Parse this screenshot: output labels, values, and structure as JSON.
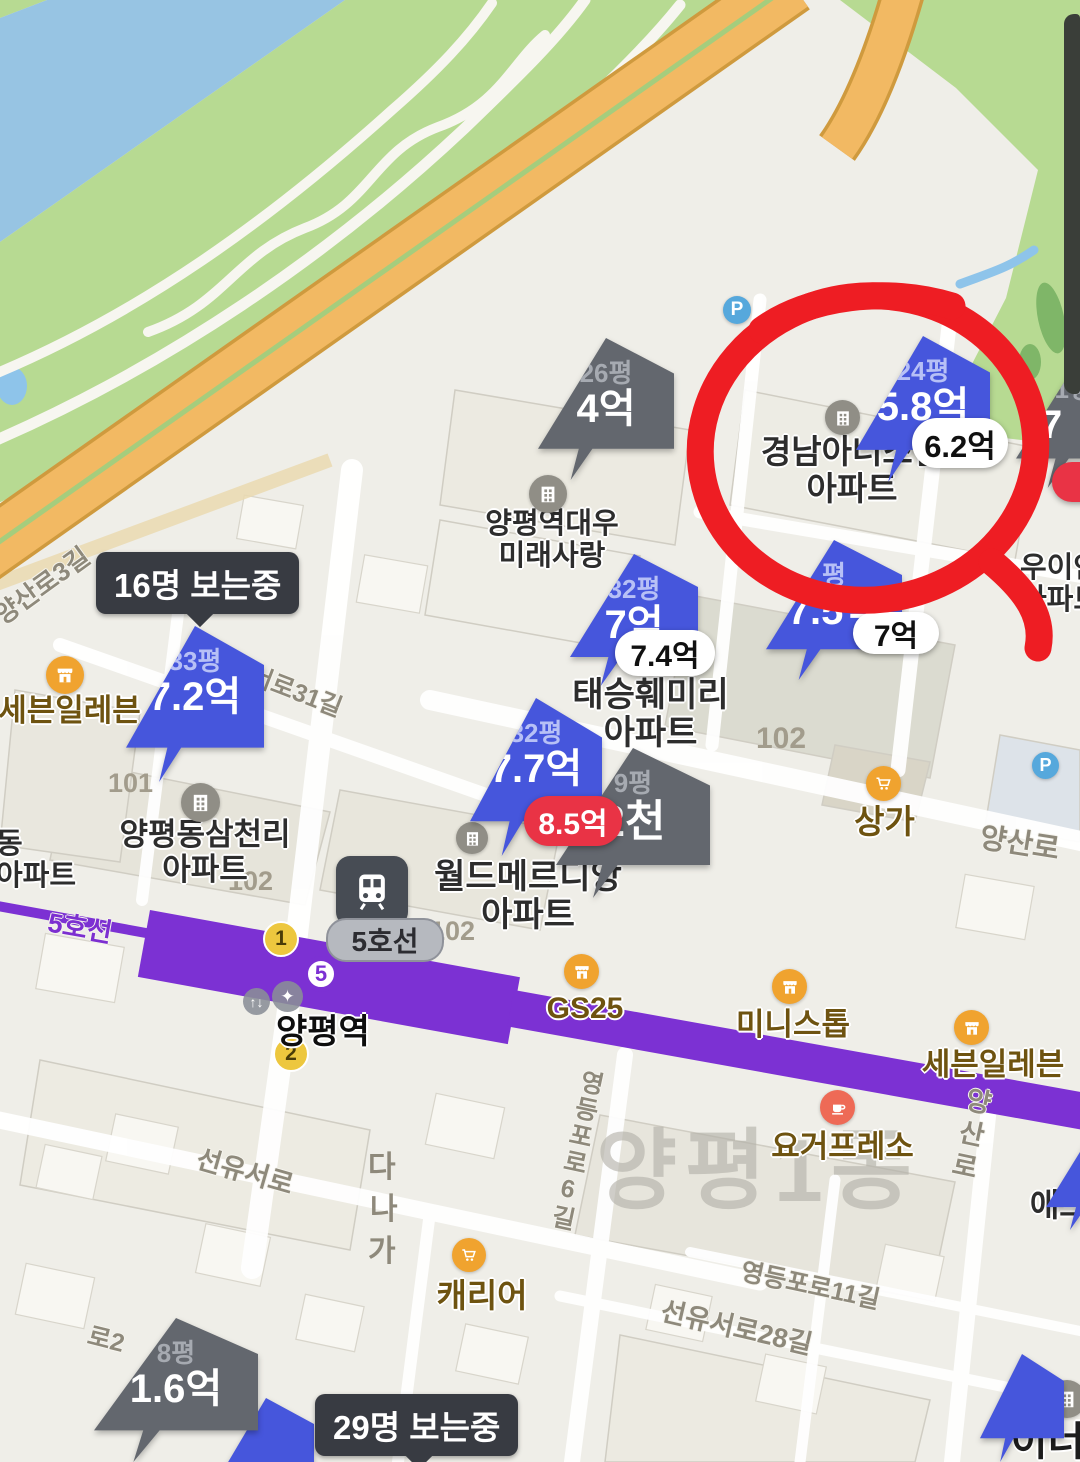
{
  "watermark": "양평1동",
  "viewers": {
    "badge16": "16명 보는중",
    "badge29": "29명 보는중"
  },
  "markers": {
    "gyeongnam": {
      "size": "24평",
      "price": "5.8억",
      "bubble": "6.2억"
    },
    "daewoo": {
      "size": "26평",
      "price": "4억"
    },
    "p41": {
      "size": "41평",
      "price": "7"
    },
    "mid75": {
      "size": "평",
      "price": "7.5억",
      "bubble": "7억"
    },
    "taeseung": {
      "size": "32평",
      "price": "7억",
      "bubble": "7.4억"
    },
    "samchonri": {
      "size": "33평",
      "price": "7.2억"
    },
    "meridian": {
      "size": "32평",
      "price": "7.7억",
      "bubble": "8.5억"
    },
    "small9": {
      "size": "9평",
      "price": "2천"
    },
    "p8": {
      "size": "8평",
      "price": "1.6억"
    }
  },
  "subway": {
    "line_label_on_line": "5호선",
    "line_bubble": "5호선",
    "station": "양평역",
    "line_number": "5",
    "exit1": "1",
    "exit2": "2",
    "facility1": "↑↓",
    "facility2": "✦"
  },
  "apartments": {
    "gyeongnam": {
      "line1": "경남아너스빌",
      "line2": "아파트"
    },
    "daewoo": {
      "line1": "양평역대우",
      "line2": "미래사랑"
    },
    "taeseung": {
      "line1": "태승훼미리",
      "line2": "아파트"
    },
    "samchonri": {
      "line1": "양평동삼천리",
      "line2": "아파트"
    },
    "meridian": {
      "line1": "월드메르디앙",
      "line2": "아파트"
    },
    "uian": {
      "line1": "우이안",
      "line2": "아파트"
    },
    "left_edge": {
      "line1": "동",
      "line2": "아파트"
    },
    "inners": {
      "text": "이너스"
    },
    "adwon": {
      "text": "애드원"
    }
  },
  "stores": {
    "gs25": "GS25",
    "ministop": "미니스톱",
    "seven_right": "세븐일레븐",
    "seven_left": "세븐일레븐",
    "yogurpresso": "요거프레소",
    "carrier": "캐리어",
    "sangga": "상가",
    "parking": "P"
  },
  "roads": {
    "yangsan3": "양산로3길",
    "seoro31": "서로31길",
    "yangsanro_h": "양산로",
    "yangsanro_v": "양산로",
    "ydp6": "영등포로6길",
    "sunyuseoro": "선유서로",
    "sunyu28": "선유서로28길",
    "ydp11": "영등포로11길",
    "ro2": "로2"
  },
  "block_numbers": {
    "n101": "101",
    "n102a": "102",
    "n102b": "102",
    "n102c": "102"
  },
  "block_letters": {
    "da": "다",
    "na": "나",
    "ga": "가"
  },
  "colors": {
    "marker_blue": "#4656dc",
    "marker_gray": "#63676e",
    "bubble_red": "#e93345",
    "hand_circle_red": "#ee1d23",
    "subway_purple": "#7c31d3",
    "viewers_badge": "#383b42",
    "exit_yellow": "#edc73e",
    "river_blue": "#97c4e3",
    "park_green": "#b7da92",
    "road_orange": "#f2b963"
  }
}
